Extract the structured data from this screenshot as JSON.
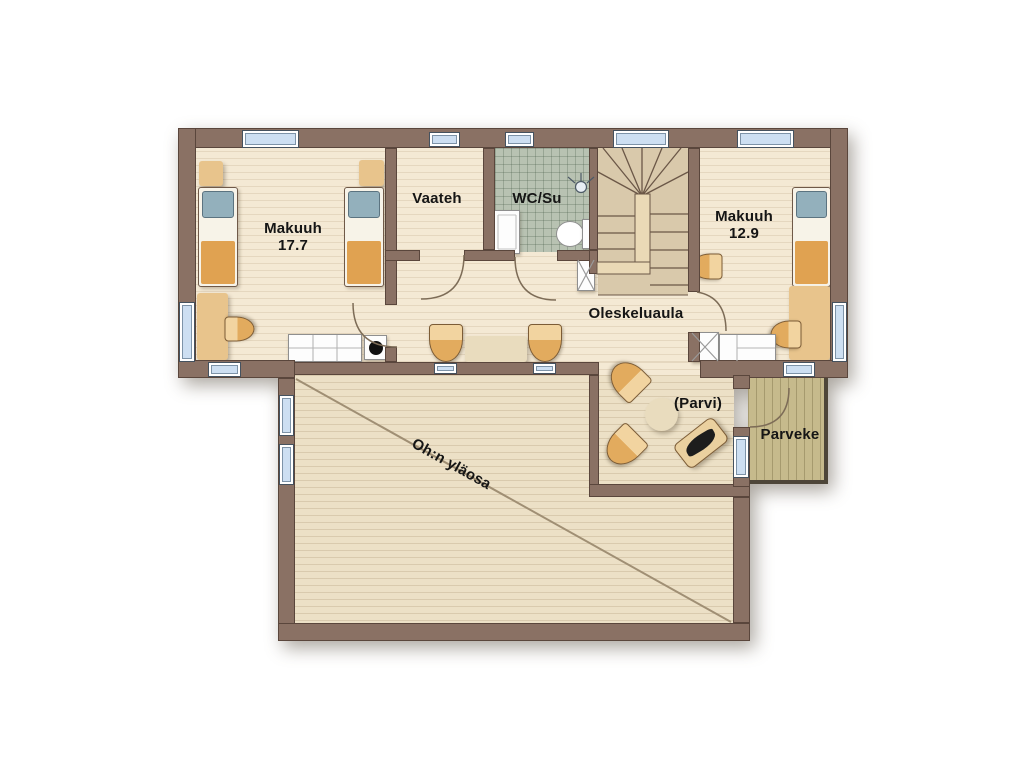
{
  "plan": {
    "type": "architectural-floor-plan",
    "floor": "upper",
    "labels": {
      "bedroom1": {
        "name": "Makuuh",
        "area": "17.7"
      },
      "closet": {
        "name": "Vaateh"
      },
      "wc": {
        "name": "WC/Su"
      },
      "bedroom2": {
        "name": "Makuuh",
        "area": "12.9"
      },
      "lounge": {
        "name": "Oleskeluaula"
      },
      "loft": {
        "name": "(Parvi)"
      },
      "balcony": {
        "name": "Parveke"
      },
      "void": {
        "name": "Oh:n yläosa"
      }
    },
    "colors": {
      "wall": "#8a7164",
      "wall_outline": "#5a463c",
      "floor_cream": "#f4e9d4",
      "floor_void": "#ece0c6",
      "wc_tiles": "#b8c2b2",
      "stairs": "#d9c9ab",
      "balcony_deck": "#c6ba8c",
      "window_glass": "#cddff2",
      "furniture_tan": "#e8c48c",
      "blanket_orange": "#e0a251",
      "pillow_blue": "#93b0bc",
      "text": "#151515"
    }
  }
}
